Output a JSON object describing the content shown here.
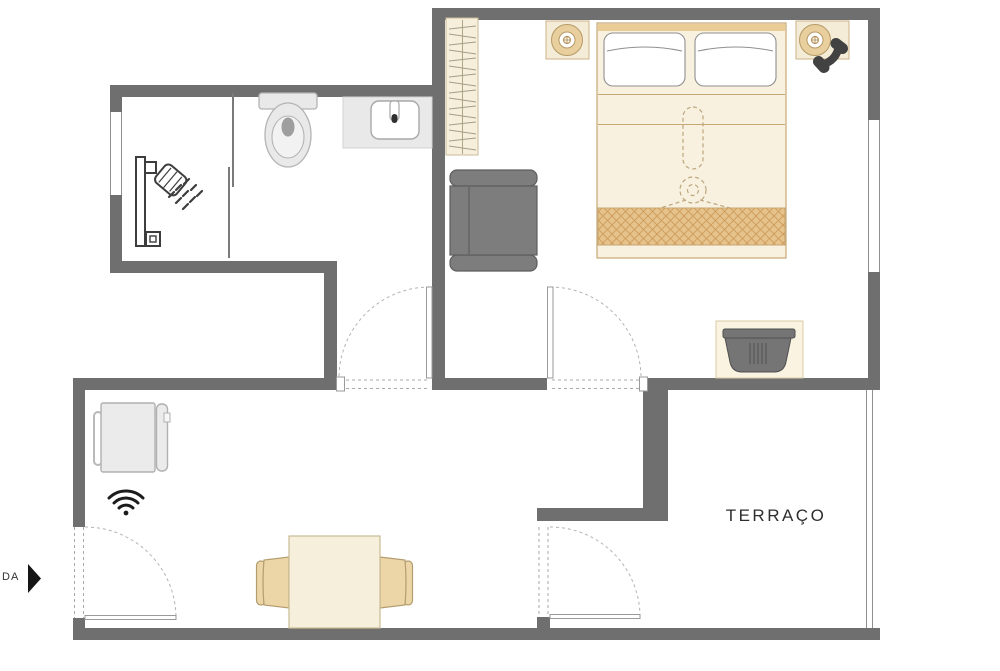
{
  "labels": {
    "terrace": "TERRAÇO",
    "entrance_partial": "DA"
  },
  "colors": {
    "wall": "#6f6f6f",
    "window_line": "#8f8f8f",
    "bed_beige": "#f8f1e0",
    "headboard_tan": "#e9cc96",
    "blanket_band": "#e6c28c",
    "blanket_hatch": "#cf9f60",
    "chair_beige": "#ecd6a8",
    "table_cream": "#f6efdc",
    "nightstand_cream": "#f4ecd7",
    "lamp_tan": "#e8cf9d",
    "armchair_gray": "#7d7d7d",
    "basket_gray": "#757575",
    "fixture_gray": "#e9e9e9",
    "appliance_gray": "#ebebeb",
    "icon_dark": "#3d3d3d",
    "phone_dark": "#424242",
    "door_arc": "#b3b3b3",
    "fan_dash": "#bda57c",
    "text": "#2e2e2e"
  },
  "icons": [
    "shower-icon",
    "shower-screen",
    "toilet-icon",
    "sink-icon",
    "wardrobe-hangers-icon",
    "bed-icon",
    "pillow",
    "ceiling-fan-dashed-icon",
    "nightstand-lamp-icon",
    "phone-icon",
    "armchair-icon",
    "laundry-basket-icon",
    "fridge-icon",
    "wifi-icon",
    "dining-table-icon",
    "dining-chair-icon",
    "door-swing-arc",
    "window",
    "entrance-arrow-icon"
  ]
}
